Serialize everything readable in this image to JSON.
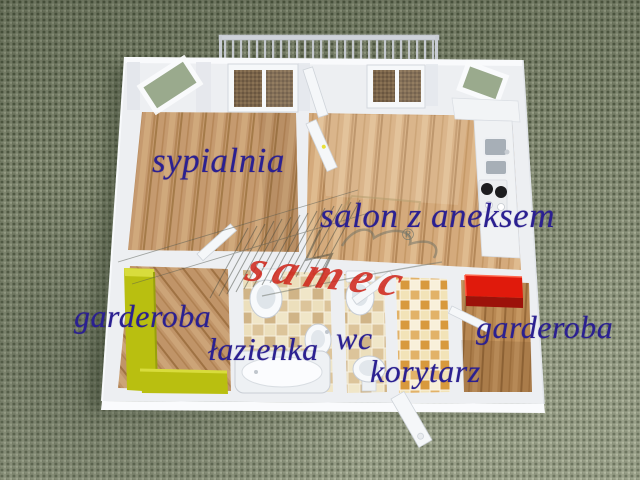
{
  "scene": {
    "description": "3D rendered apartment floor plan viewed from above on a green woven fabric background",
    "background_color": "#8b927a",
    "label_color": "#2b2091",
    "rooms": [
      {
        "id": "sypialnia",
        "label": "sypialnia",
        "floor": "wood"
      },
      {
        "id": "salon",
        "label": "salon z aneksem",
        "floor": "wood",
        "features": [
          "kitchen annex with sink and stove",
          "balcony railing",
          "windows"
        ]
      },
      {
        "id": "garderoba-left",
        "label": "garderoba",
        "floor": "wood",
        "features": [
          "lime-green wardrobe"
        ],
        "accent_color": "#b9bf10"
      },
      {
        "id": "lazienka",
        "label": "łazienka",
        "floor": "beige tile",
        "features": [
          "bathtub",
          "toilet",
          "washbasin"
        ]
      },
      {
        "id": "wc",
        "label": "wc",
        "floor": "beige tile",
        "features": [
          "toilet",
          "washbasin"
        ]
      },
      {
        "id": "korytarz",
        "label": "korytarz",
        "floor": "mosaic tile",
        "features": [
          "entrance door"
        ]
      },
      {
        "id": "garderoba-right",
        "label": "garderoba",
        "floor": "wood",
        "features": [
          "red cabinet"
        ],
        "accent_color": "#d21408"
      }
    ],
    "watermark": {
      "text": "samec",
      "registered": "®",
      "color": "#cf2318"
    }
  }
}
